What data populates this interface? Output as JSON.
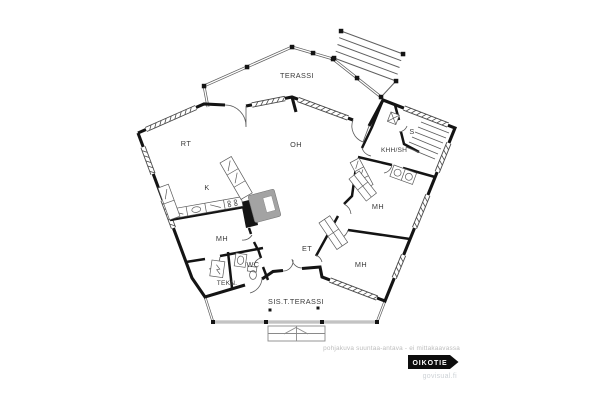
{
  "rooms": {
    "terassi": {
      "label": "TERASSI"
    },
    "rt": {
      "label": "RT"
    },
    "oh": {
      "label": "OH"
    },
    "s": {
      "label": "S"
    },
    "khh_sh": {
      "label": "KHH/SH"
    },
    "k": {
      "label": "K"
    },
    "mh_left": {
      "label": "MH"
    },
    "wc": {
      "label": "WC"
    },
    "tekn": {
      "label": "TEKN."
    },
    "et": {
      "label": "ET"
    },
    "mh_upper": {
      "label": "MH"
    },
    "mh_lower": {
      "label": "MH"
    },
    "sis_t_terassi": {
      "label": "SIS.T.TERASSI"
    }
  },
  "footer": {
    "disclaimer": "pohjakuva suuntaa-antava - ei mittakaavassa",
    "brand": "OIKOTIE",
    "watermark": "govisual.fi"
  },
  "colors": {
    "wall": "#141414",
    "line": "#5f5f5f",
    "thin": "#8a8a8a",
    "fireplace": "#a3a3a3",
    "label": "#3a3a3a",
    "muted": "#bdbdbd",
    "watermark": "#cdd2d6",
    "brand_bg": "#0d0d0d",
    "brand_text": "#ffffff"
  }
}
